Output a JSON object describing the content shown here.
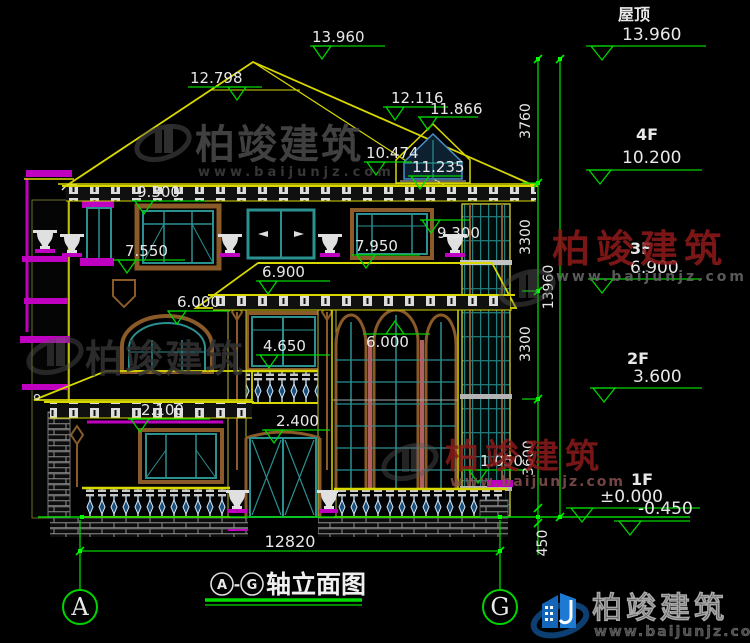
{
  "drawing": {
    "title": "轴立面图",
    "axis_start": "A",
    "axis_end": "G",
    "axis_separator": "-"
  },
  "floor_levels": [
    {
      "name": "屋顶",
      "elevation": "13.960"
    },
    {
      "name": "4F",
      "elevation": "10.200"
    },
    {
      "name": "3F",
      "elevation": "6.900"
    },
    {
      "name": "2F",
      "elevation": "3.600"
    },
    {
      "name": "1F",
      "elevation": "±0.000",
      "below": "-0.450"
    }
  ],
  "dimensions": {
    "vertical_segments": [
      "3760",
      "3300",
      "3300",
      "3600",
      "450"
    ],
    "vertical_overall": "13960",
    "bottom_overall": "12820"
  },
  "elevation_marks": {
    "ridge": "13.960",
    "ridge_left": "12.798",
    "dormer_ridge": "12.116",
    "dormer_right": "11.866",
    "dormer_sill": "10.474",
    "dormer_eave": "11.235",
    "eave_left": "9.300",
    "eave_right": "9.300",
    "sill3f_left": "7.550",
    "sill3f_right": "7.950",
    "midroof_ridge": "6.900",
    "midroof_eave": "6.000",
    "arch_spring": "6.000",
    "sill2f": "4.650",
    "door_head": "2.400",
    "porch_eave": "2.100",
    "railing_top": "1.050"
  },
  "watermark": {
    "brand": "柏竣建筑",
    "url": "www.baijunjz.com"
  },
  "colors": {
    "background": "#000000",
    "dimension_green": "#00d400",
    "outline_yellow": "#d8d800",
    "window_teal": "#2a9090",
    "frame_brown": "#8a5a28",
    "accent_magenta": "#c000c0",
    "watermark_red": "#8c1a1a",
    "logo_blue": "#1a6abf",
    "text_white": "#e8e8e8"
  }
}
